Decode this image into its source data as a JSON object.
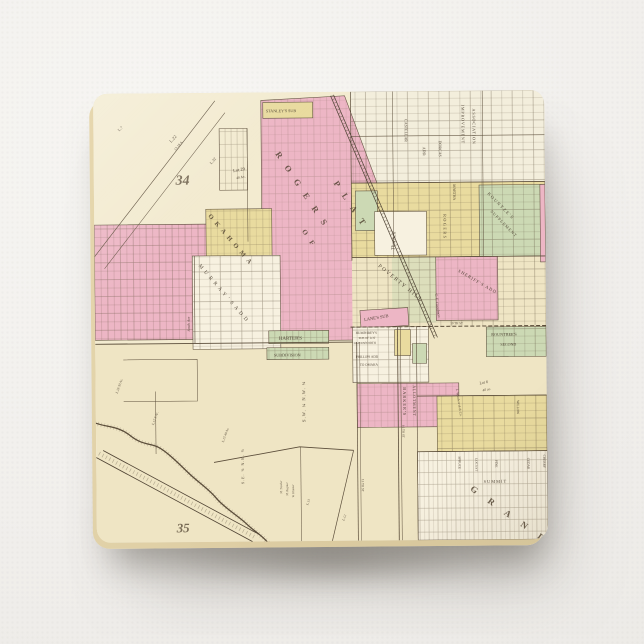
{
  "palette": {
    "paper": "#f3f1ee",
    "cream": "#efe5c4",
    "cream_light": "#f3ebd0",
    "cream_ne": "#f3eedc",
    "pink": "#edb6c5",
    "yellow": "#e9db9f",
    "green": "#ccd9b4",
    "white_parcel": "#f7f1e0",
    "line": "#5b4d3a",
    "rail": "#4e4233",
    "ink": "#44382a",
    "edge": "#e6d7ae"
  },
  "map": {
    "labels": [
      {
        "name": "section-34",
        "text": "34",
        "x": 82,
        "y": 92,
        "rot": 0,
        "size": 14,
        "cls": "num"
      },
      {
        "name": "section-35",
        "text": "35",
        "x": 80,
        "y": 442,
        "rot": 0,
        "size": 13,
        "cls": "num"
      },
      {
        "name": "lot-22",
        "text": "L.22",
        "x": 78,
        "y": 50,
        "rot": -48,
        "size": 4.5
      },
      {
        "name": "lot-22-acres",
        "text": "13.18 A.",
        "x": 82,
        "y": 58,
        "rot": -48,
        "size": 3.6
      },
      {
        "name": "lot-32",
        "text": "L.32",
        "x": 118,
        "y": 72,
        "rot": -48,
        "size": 4
      },
      {
        "name": "lot-7",
        "text": "L.7",
        "x": 26,
        "y": 38,
        "rot": -45,
        "size": 4
      },
      {
        "name": "lot-29",
        "text": "Lot 29",
        "x": 140,
        "y": 80,
        "rot": -10,
        "size": 4.5
      },
      {
        "name": "lot-29-acres",
        "text": "40 Ac.",
        "x": 143,
        "y": 87,
        "rot": -10,
        "size": 3.6
      },
      {
        "name": "okahoma-title",
        "text": "O K A H O M A",
        "x": 114,
        "y": 124,
        "rot": 50,
        "size": 6.5,
        "ls": 1.6,
        "cls": "caps"
      },
      {
        "name": "rogers-title",
        "text": "R O G E R S",
        "x": 182,
        "y": 62,
        "rot": 57,
        "size": 8.5,
        "ls": 4,
        "cls": "caps"
      },
      {
        "name": "plat-title",
        "text": "P L A T",
        "x": 240,
        "y": 92,
        "rot": 57,
        "size": 8.5,
        "ls": 4,
        "cls": "caps"
      },
      {
        "name": "of-title",
        "text": "O F",
        "x": 208,
        "y": 140,
        "rot": 57,
        "size": 7,
        "ls": 3,
        "cls": "caps"
      },
      {
        "name": "stanleys-sub",
        "text": "STANLEY'S SUB",
        "x": 173,
        "y": 20,
        "rot": 0,
        "size": 4.1
      },
      {
        "name": "improvement",
        "text": "IMPROVEMENT",
        "x": 369,
        "y": 14,
        "rot": 90,
        "size": 4.2,
        "ls": 0.8
      },
      {
        "name": "association",
        "text": "ASSOCIATION",
        "x": 380,
        "y": 18,
        "rot": 90,
        "size": 4.2,
        "ls": 0.8
      },
      {
        "name": "castellar-st",
        "text": "CASTELLAR",
        "x": 312,
        "y": 28,
        "rot": 90,
        "size": 4
      },
      {
        "name": "add-label",
        "text": "ADD.",
        "x": 330,
        "y": 56,
        "rot": 90,
        "size": 4
      },
      {
        "name": "dorcas-st",
        "text": "DORCAS",
        "x": 346,
        "y": 50,
        "rot": 90,
        "size": 4
      },
      {
        "name": "martha-st",
        "text": "MARTHA",
        "x": 360,
        "y": 94,
        "rot": 90,
        "size": 3.8
      },
      {
        "name": "rogers-street",
        "text": "ROGERS",
        "x": 350,
        "y": 124,
        "rot": 90,
        "size": 4.2,
        "ls": 1.5
      },
      {
        "name": "thornell",
        "text": "Thornell",
        "x": 301,
        "y": 160,
        "rot": -87,
        "size": 5.5,
        "cls": "script"
      },
      {
        "name": "kountzes",
        "text": "KOUNTZE'S",
        "x": 394,
        "y": 104,
        "rot": 46,
        "size": 4.4,
        "ls": 1.4
      },
      {
        "name": "supplement",
        "text": "SUPPLEMENT",
        "x": 397,
        "y": 122,
        "rot": 46,
        "size": 4.1,
        "ls": 1
      },
      {
        "name": "poverty-hill",
        "text": "POVERTY  HILL",
        "x": 284,
        "y": 176,
        "rot": 40,
        "size": 5.5,
        "ls": 1.5
      },
      {
        "name": "sheriffs-add",
        "text": "SHERIFF'S  ADD",
        "x": 364,
        "y": 182,
        "rot": 31,
        "size": 4.4,
        "ls": 1
      },
      {
        "name": "lanes-sub",
        "text": "LANE'S SUB",
        "x": 270,
        "y": 231,
        "rot": -9,
        "size": 4.4
      },
      {
        "name": "harters",
        "text": "HARTER'S",
        "x": 184,
        "y": 249,
        "rot": 0,
        "size": 5
      },
      {
        "name": "subdivision",
        "text": "SUBDIVISION",
        "x": 179,
        "y": 266,
        "rot": 0,
        "size": 4.2
      },
      {
        "name": "murrays-add",
        "text": "M U R R A Y ' S  A D D",
        "x": 104,
        "y": 174,
        "rot": 50,
        "size": 5.2,
        "ls": 1.2
      },
      {
        "name": "south-ave",
        "text": "South Ave",
        "x": 95,
        "y": 240,
        "rot": -90,
        "size": 3.8,
        "cls": "script"
      },
      {
        "name": "humphreys",
        "text": "HUMPHREY'S",
        "x": 261,
        "y": 244,
        "rot": 0,
        "size": 3.4
      },
      {
        "name": "humphreys-sub",
        "text": "SUB OF LOT",
        "x": 264,
        "y": 249,
        "rot": 0,
        "size": 3
      },
      {
        "name": "leavenworth",
        "text": "LEAVENWORTH",
        "x": 259,
        "y": 254,
        "rot": 0,
        "size": 3
      },
      {
        "name": "phillips-add",
        "text": "PHILLIPS  ADD",
        "x": 261,
        "y": 268,
        "rot": 0,
        "size": 3.4
      },
      {
        "name": "to-omaha",
        "text": "TO  OMAHA",
        "x": 265,
        "y": 276,
        "rot": 0,
        "size": 3.4
      },
      {
        "name": "barkers",
        "text": "BARKER'S",
        "x": 308,
        "y": 298,
        "rot": 90,
        "size": 4.4,
        "ls": 1
      },
      {
        "name": "allotment",
        "text": "ALLOTMENT",
        "x": 318,
        "y": 296,
        "rot": 90,
        "size": 4,
        "ls": 0.8
      },
      {
        "name": "rountrees",
        "text": "ROUNTREE'S",
        "x": 397,
        "y": 247,
        "rot": 0,
        "size": 4.2
      },
      {
        "name": "second",
        "text": "SECOND",
        "x": 406,
        "y": 257,
        "rot": 0,
        "size": 4
      },
      {
        "name": "goodman",
        "text": "C. F. Goodman",
        "x": 341,
        "y": 204,
        "rot": 84,
        "size": 4,
        "cls": "script"
      },
      {
        "name": "lot-6",
        "text": "Lot 6",
        "x": 385,
        "y": 296,
        "rot": -12,
        "size": 4.2,
        "cls": "script"
      },
      {
        "name": "lot-6-acres",
        "text": "40 ac.",
        "x": 388,
        "y": 303,
        "rot": -12,
        "size": 3.6,
        "cls": "script"
      },
      {
        "name": "woodworth",
        "text": "L. Woodworth & Co.",
        "x": 361,
        "y": 300,
        "rot": 82,
        "size": 3.4,
        "cls": "script"
      },
      {
        "name": "summit-st",
        "text": "SUMMIT",
        "x": 388,
        "y": 395,
        "rot": 0,
        "size": 4.4,
        "ls": 1
      },
      {
        "name": "grand-title",
        "text": "G R A N D",
        "x": 374,
        "y": 402,
        "rot": 36,
        "size": 9,
        "ls": 6,
        "cls": "caps"
      },
      {
        "name": "spruce-st",
        "text": "SPRUCE",
        "x": 363,
        "y": 368,
        "rot": 90,
        "size": 3.4
      },
      {
        "name": "locust-st",
        "text": "LOCUST",
        "x": 380,
        "y": 370,
        "rot": 90,
        "size": 3.4
      },
      {
        "name": "pine-st",
        "text": "PINE",
        "x": 400,
        "y": 372,
        "rot": 90,
        "size": 3.4
      },
      {
        "name": "cedar-st",
        "text": "CEDAR",
        "x": 432,
        "y": 370,
        "rot": 90,
        "size": 3.4
      },
      {
        "name": "cherry-st",
        "text": "CHERRY",
        "x": 448,
        "y": 367,
        "rot": 90,
        "size": 3.4
      },
      {
        "name": "willow-st",
        "text": "WILLOW",
        "x": 422,
        "y": 312,
        "rot": 90,
        "size": 3.4
      },
      {
        "name": "tenth-st",
        "text": "10 TH ST",
        "x": 356,
        "y": 235,
        "rot": 0,
        "size": 3.2
      },
      {
        "name": "sixteenth-st",
        "text": "16 TH ST",
        "x": 307,
        "y": 336,
        "rot": 90,
        "size": 3.2
      },
      {
        "name": "thirteenth-st",
        "text": "13 TH ST",
        "x": 266,
        "y": 390,
        "rot": 90,
        "size": 3.2
      },
      {
        "name": "sw-quarter",
        "text": "S.W. ¼  N.W. ¼",
        "x": 210,
        "y": 332,
        "rot": -90,
        "size": 4.6,
        "ls": 1
      },
      {
        "name": "se-quarter",
        "text": "S.E. ¼  N.E. ¼",
        "x": 148,
        "y": 394,
        "rot": -90,
        "size": 4,
        "ls": 1
      },
      {
        "name": "owner-1",
        "text": "M. Trostler",
        "x": 186,
        "y": 404,
        "rot": -90,
        "size": 3,
        "cls": "script"
      },
      {
        "name": "owner-2",
        "text": "M. Regnier",
        "x": 192,
        "y": 406,
        "rot": -90,
        "size": 3,
        "cls": "script"
      },
      {
        "name": "owner-3",
        "text": "W. Klinster",
        "x": 198,
        "y": 408,
        "rot": -90,
        "size": 3,
        "cls": "script"
      },
      {
        "name": "lot-18",
        "text": "L.18  30 Ac.",
        "x": 22,
        "y": 302,
        "rot": -70,
        "size": 3.4,
        "cls": "script"
      },
      {
        "name": "lot-17",
        "text": "L.17  5 Ac.",
        "x": 58,
        "y": 334,
        "rot": -70,
        "size": 3.4,
        "cls": "script"
      },
      {
        "name": "lot-15",
        "text": "L.15  40 Ac.",
        "x": 128,
        "y": 352,
        "rot": -70,
        "size": 3.4,
        "cls": "script"
      },
      {
        "name": "lot-13",
        "text": "L.13",
        "x": 212,
        "y": 416,
        "rot": -70,
        "size": 3.4,
        "cls": "script"
      },
      {
        "name": "lot-12",
        "text": "L.12",
        "x": 248,
        "y": 432,
        "rot": -70,
        "size": 3.4,
        "cls": "script"
      }
    ]
  }
}
